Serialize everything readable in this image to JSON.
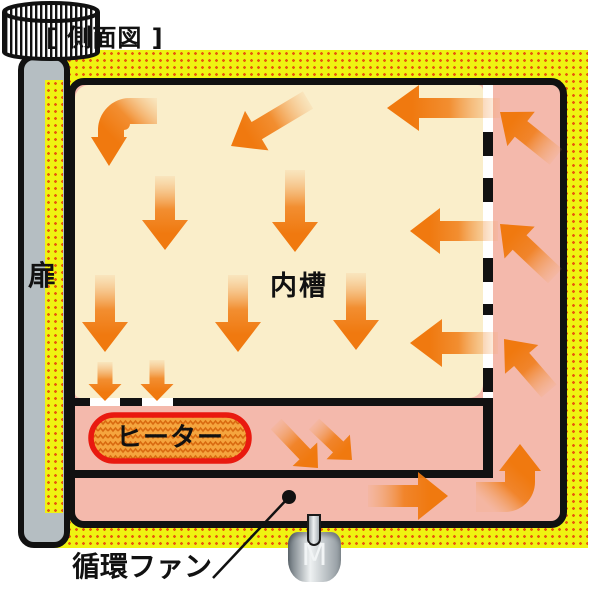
{
  "title": "[ 側面図 ]",
  "labels": {
    "door": "扉",
    "inner_chamber": "内槽",
    "heater": "ヒーター",
    "circulation_fan": "循環ファン",
    "motor": "M"
  },
  "colors": {
    "insulation_yellow": "#eff312",
    "insulation_dot": "#e8590c",
    "chamber_cream": "#faeeca",
    "duct_pink": "#f4b9ac",
    "arrow_orange": "#f0790f",
    "arrow_tail_orange": "#f2a45c",
    "heater_fill": "#f5a53e",
    "heater_zigzag": "#d96a10",
    "heater_border_red": "#e9190f",
    "door_gray": "#b5bec2",
    "outline_black": "#111111"
  },
  "flow_arrows": {
    "straight": [
      {
        "name": "flow-arrow-down-left",
        "x1": 308,
        "y1": 100,
        "x2": 231,
        "y2": 146,
        "body": 20,
        "hw": 46,
        "hl": 30
      },
      {
        "name": "flow-arrow-left",
        "x1": 500,
        "y1": 108,
        "x2": 387,
        "y2": 108,
        "body": 20,
        "hw": 46,
        "hl": 32
      },
      {
        "name": "flow-arrow-down",
        "x1": 165,
        "y1": 176,
        "x2": 165,
        "y2": 250,
        "body": 20,
        "hw": 46,
        "hl": 30
      },
      {
        "name": "flow-arrow-down",
        "x1": 295,
        "y1": 170,
        "x2": 295,
        "y2": 252,
        "body": 20,
        "hw": 46,
        "hl": 30
      },
      {
        "name": "flow-arrow-left",
        "x1": 498,
        "y1": 231,
        "x2": 410,
        "y2": 231,
        "body": 20,
        "hw": 46,
        "hl": 30
      },
      {
        "name": "flow-arrow-down",
        "x1": 105,
        "y1": 275,
        "x2": 105,
        "y2": 352,
        "body": 20,
        "hw": 46,
        "hl": 30
      },
      {
        "name": "flow-arrow-down",
        "x1": 238,
        "y1": 275,
        "x2": 238,
        "y2": 352,
        "body": 20,
        "hw": 46,
        "hl": 30
      },
      {
        "name": "flow-arrow-down",
        "x1": 356,
        "y1": 273,
        "x2": 356,
        "y2": 350,
        "body": 20,
        "hw": 46,
        "hl": 30
      },
      {
        "name": "flow-arrow-left",
        "x1": 498,
        "y1": 343,
        "x2": 410,
        "y2": 343,
        "body": 22,
        "hw": 48,
        "hl": 32
      },
      {
        "name": "flow-arrow-down-small",
        "x1": 105,
        "y1": 362,
        "x2": 105,
        "y2": 401,
        "body": 15,
        "hw": 33,
        "hl": 17
      },
      {
        "name": "flow-arrow-down-small",
        "x1": 157,
        "y1": 360,
        "x2": 157,
        "y2": 401,
        "body": 15,
        "hw": 33,
        "hl": 17
      },
      {
        "name": "flow-arrow-up-left",
        "x1": 556,
        "y1": 157,
        "x2": 500,
        "y2": 112,
        "body": 20,
        "hw": 44,
        "hl": 27
      },
      {
        "name": "flow-arrow-up-left",
        "x1": 555,
        "y1": 276,
        "x2": 500,
        "y2": 224,
        "body": 20,
        "hw": 44,
        "hl": 27
      },
      {
        "name": "flow-arrow-up-left",
        "x1": 549,
        "y1": 391,
        "x2": 504,
        "y2": 339,
        "body": 20,
        "hw": 44,
        "hl": 27
      },
      {
        "name": "flow-arrow-down-right",
        "x1": 276,
        "y1": 424,
        "x2": 318,
        "y2": 468,
        "body": 15,
        "hw": 34,
        "hl": 19
      },
      {
        "name": "flow-arrow-down-right",
        "x1": 314,
        "y1": 424,
        "x2": 352,
        "y2": 460,
        "body": 15,
        "hw": 34,
        "hl": 19
      },
      {
        "name": "flow-arrow-right",
        "x1": 368,
        "y1": 496,
        "x2": 448,
        "y2": 496,
        "body": 22,
        "hw": 48,
        "hl": 30
      }
    ],
    "curved": [
      {
        "name": "flow-arrow-curve-down",
        "d": "M157,98 H130 A32,32 0 0 0 98,130 V137 H91 L109,166 L127,137 H124 V130 A6,6 0 0 0 130,124 H157 Z",
        "x1": 157,
        "y1": 100,
        "x2": 104,
        "y2": 152
      },
      {
        "name": "flow-arrow-curve-up",
        "d": "M476,482 H505 V471 H499 L520,444 L541,471 H535 V482 A30,30 0 0 1 505,512 H476 Z",
        "x1": 478,
        "y1": 497,
        "x2": 520,
        "y2": 452
      }
    ]
  },
  "pointer": {
    "line": {
      "x1": 213,
      "y1": 578,
      "x2": 289,
      "y2": 497
    },
    "dot": {
      "cx": 289,
      "cy": 497,
      "r": 7
    }
  }
}
